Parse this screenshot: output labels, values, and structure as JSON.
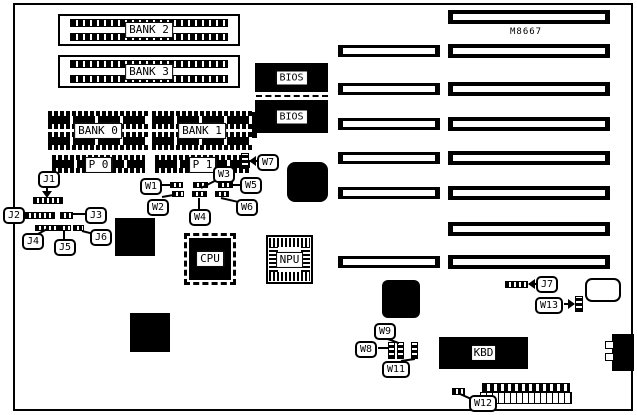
{
  "model_text": "M8667",
  "colors": {
    "ink": "#000000",
    "paper": "#ffffff"
  },
  "memory": {
    "simm_banks": [
      {
        "label": "BANK 2"
      },
      {
        "label": "BANK 3"
      }
    ],
    "dip_banks": [
      {
        "label": "BANK 0"
      },
      {
        "label": "BANK 1"
      }
    ],
    "parity_rows": [
      {
        "label": "P 0"
      },
      {
        "label": "P 1"
      }
    ]
  },
  "chips": {
    "bios_top": "BIOS",
    "bios_bottom": "BIOS",
    "cpu": "CPU",
    "npu": "NPU",
    "keyboard": "KBD"
  },
  "jumpers": {
    "j1": "J1",
    "j2": "J2",
    "j3": "J3",
    "j4": "J4",
    "j5": "J5",
    "j6": "J6",
    "j7": "J7",
    "w1": "W1",
    "w2": "W2",
    "w3": "W3",
    "w4": "W4",
    "w5": "W5",
    "w6": "W6",
    "w7": "W7",
    "w8": "W8",
    "w9": "W9",
    "w11": "W11",
    "w12": "W12",
    "w13": "W13"
  }
}
